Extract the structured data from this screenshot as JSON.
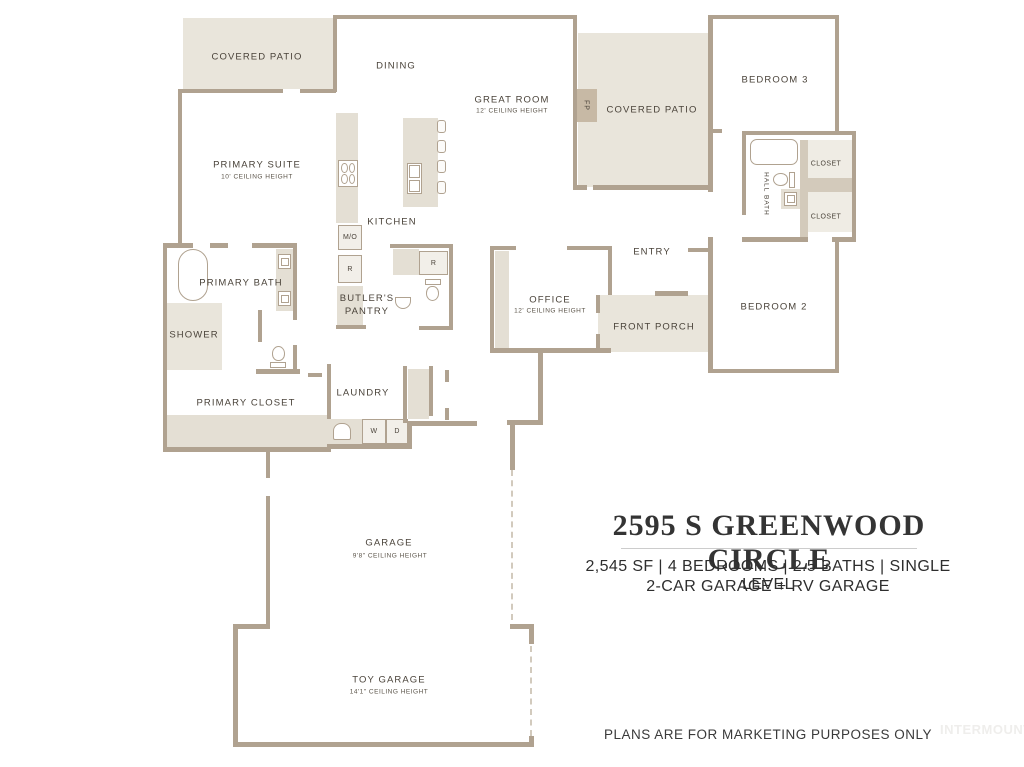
{
  "colors": {
    "wall": "#b0a290",
    "patio_fill": "#e9e5db",
    "counter_fill": "#e4dfd4",
    "accent_dark": "#c7b9a5",
    "plan_text": "#4a433a"
  },
  "labels": {
    "covered_patio_left": "COVERED PATIO",
    "dining": "DINING",
    "great_room": "GREAT ROOM",
    "great_room_sub": "12' CEILING HEIGHT",
    "covered_patio_right": "COVERED PATIO",
    "bedroom_3": "BEDROOM 3",
    "primary_suite": "PRIMARY SUITE",
    "primary_suite_sub": "10' CEILING HEIGHT",
    "kitchen": "KITCHEN",
    "butlers_pantry": "BUTLER'S PANTRY",
    "primary_bath": "PRIMARY BATH",
    "shower": "SHOWER",
    "primary_closet": "PRIMARY CLOSET",
    "laundry": "LAUNDRY",
    "entry": "ENTRY",
    "office": "OFFICE",
    "office_sub": "12' CEILING HEIGHT",
    "front_porch": "FRONT PORCH",
    "bedroom_2": "BEDROOM 2",
    "hall_bath": "HALL BATH",
    "closet_upper": "CLOSET",
    "closet_lower": "CLOSET",
    "garage": "GARAGE",
    "garage_sub": "9'8\" CEILING HEIGHT",
    "toy_garage": "TOY GARAGE",
    "toy_garage_sub": "14'1\" CEILING HEIGHT",
    "fireplace": "FP",
    "microwave_oven": "M/O",
    "refrigerator": "R",
    "washer": "W",
    "dryer": "D"
  },
  "title_block": {
    "address": "2595 S GREENWOOD CIRCLE",
    "specs_line1": "2,545 SF | 4 BEDROOMS | 2.5 BATHS | SINGLE LEVEL",
    "specs_line2": "2-CAR GARAGE + RV GARAGE"
  },
  "footer": {
    "disclaimer": "PLANS ARE FOR MARKETING PURPOSES ONLY",
    "watermark": "INTERMOUNTAIN"
  }
}
